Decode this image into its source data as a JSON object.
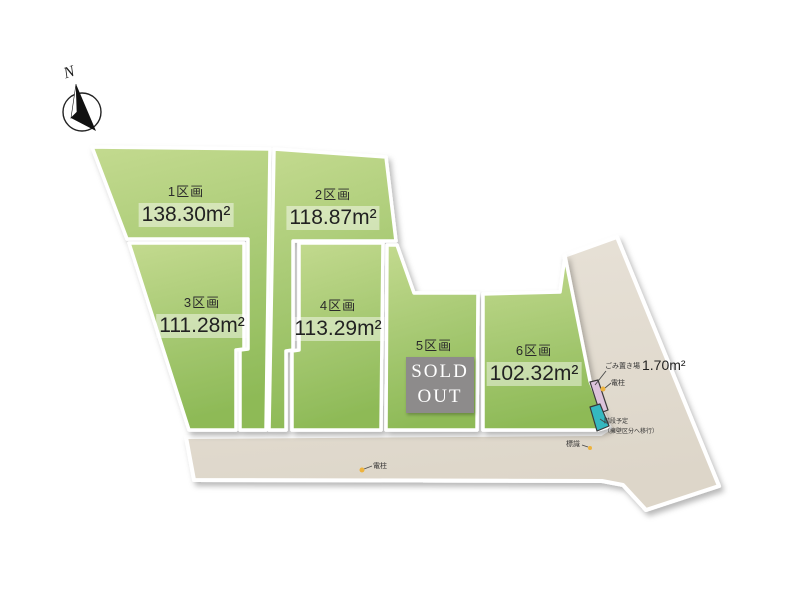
{
  "compass": {
    "label": "N"
  },
  "plots": [
    {
      "label": "1区画",
      "area": "138.30m²",
      "sold": false
    },
    {
      "label": "2区画",
      "area": "118.87m²",
      "sold": false
    },
    {
      "label": "3区画",
      "area": "111.28m²",
      "sold": false
    },
    {
      "label": "4区画",
      "area": "113.29m²",
      "sold": false
    },
    {
      "label": "5区画",
      "area": "",
      "sold": true,
      "sold_label": "SOLD OUT"
    },
    {
      "label": "6区画",
      "area": "102.32m²",
      "sold": false
    }
  ],
  "annotations": {
    "garbage_label": "ごみ置き場",
    "garbage_area": "1.70m²",
    "utility_pole_right": "電柱",
    "utility_pole_bottom": "電柱",
    "sign": "標識",
    "note_line1": "階段予定",
    "note_line2": "（擁壁区分へ移行）"
  },
  "colors": {
    "plot_green_light": "#c3da8f",
    "plot_green_mid": "#a5c871",
    "plot_green_dark": "#8eba57",
    "road_beige": "#e4ddd2",
    "sold_box_gray": "#8d8b8b",
    "garbage_pink": "#dcc3dc",
    "steps_teal": "#35b8c0",
    "marker_yellow": "#edb33e",
    "border_white": "#ffffff"
  }
}
